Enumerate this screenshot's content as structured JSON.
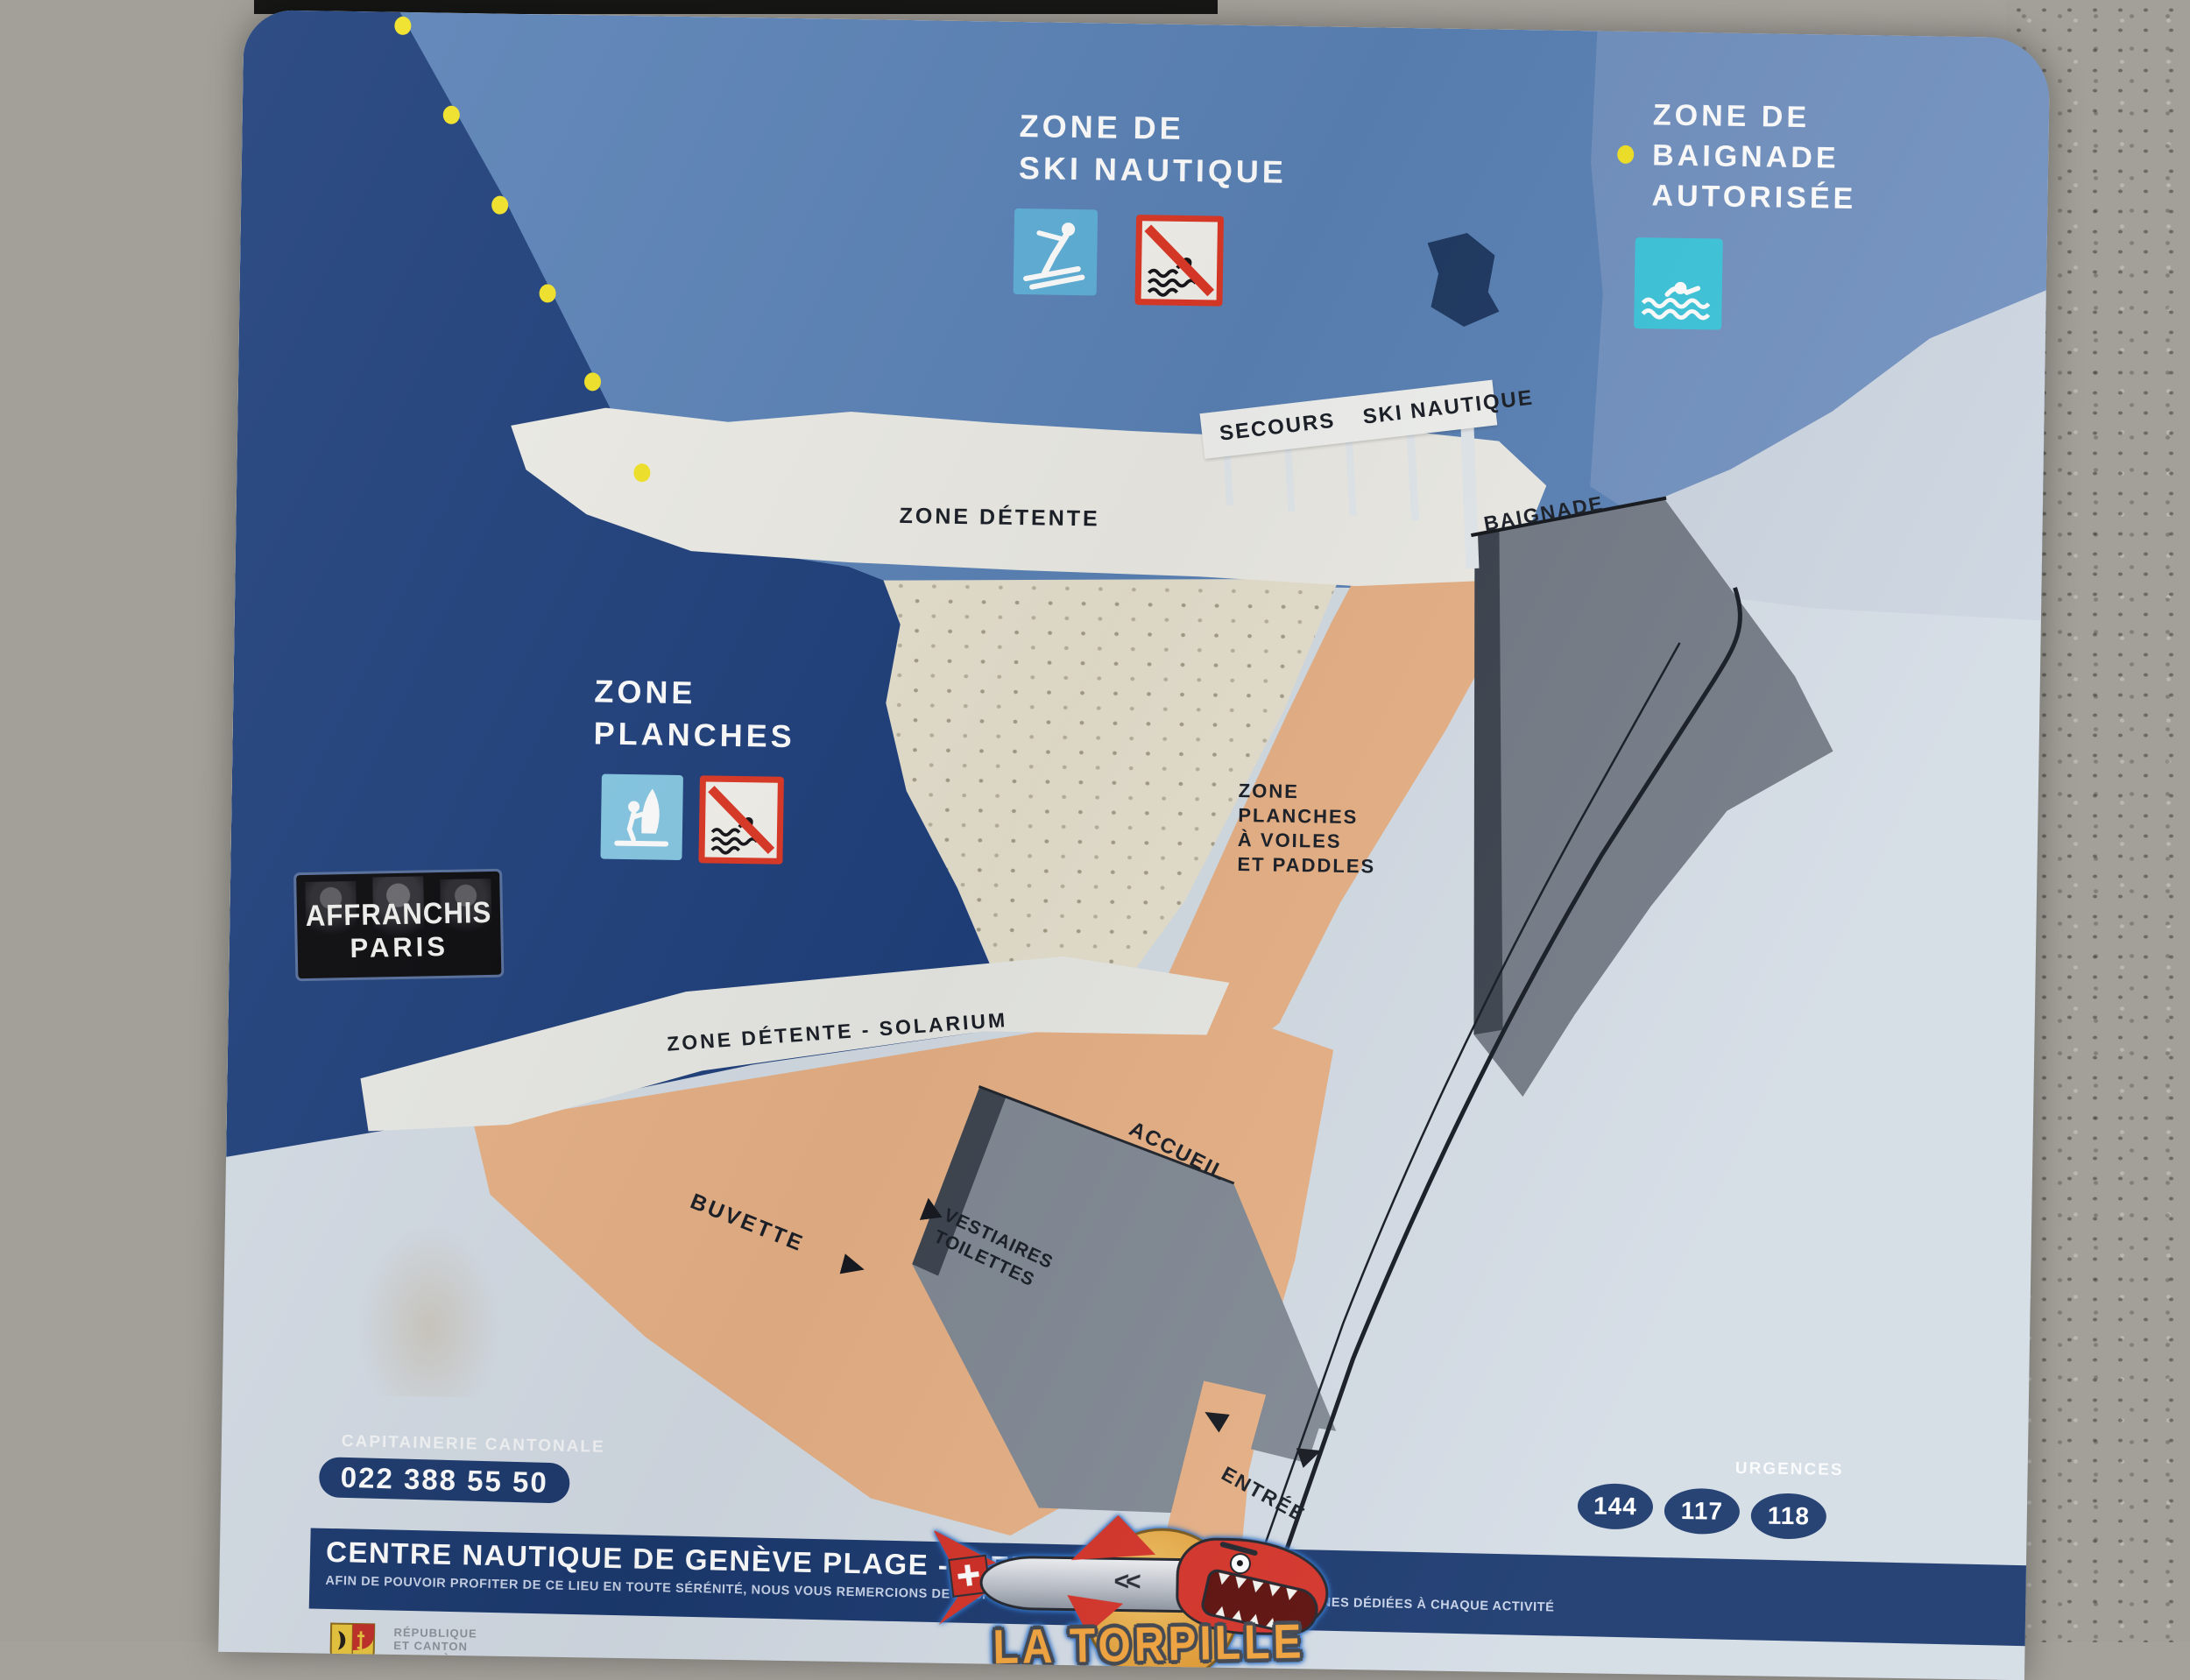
{
  "zones": {
    "ski": {
      "l1": "ZONE DE",
      "l2": "SKI NAUTIQUE"
    },
    "baignade": {
      "l1": "ZONE DE",
      "l2": "BAIGNADE",
      "l3": "AUTORISÉE"
    },
    "planches": {
      "l1": "ZONE",
      "l2": "PLANCHES"
    },
    "detente": "ZONE DÉTENTE",
    "voiles": {
      "l1": "ZONE",
      "l2": "PLANCHES",
      "l3": "À VOILES",
      "l4": "ET PADDLES"
    },
    "solarium": "ZONE DÉTENTE - SOLARIUM"
  },
  "labels": {
    "secours": "SECOURS",
    "ski_nautique": "SKI NAUTIQUE",
    "baignade": "BAIGNADE",
    "accueil": "ACCUEIL",
    "vestiaires_l1": "VESTIAIRES",
    "vestiaires_l2": "TOILETTES",
    "buvette": "BUVETTE",
    "entree": "ENTRÉE"
  },
  "capitainerie": {
    "title": "CAPITAINERIE CANTONALE",
    "phone": "022 388 55 50"
  },
  "urgences": {
    "title": "URGENCES",
    "numbers": [
      "144",
      "117",
      "118"
    ]
  },
  "footer": {
    "title": "CENTRE NAUTIQUE DE GENÈVE PLAGE - BIENVENUE",
    "subtitle": "AFIN DE POUVOIR PROFITER DE CE LIEU EN TOUTE SÉRÉNITÉ, NOUS VOUS REMERCIONS DE RESPECTER LES CONSIGNES DE SÉCURITÉ ET LES ZONES DÉDIÉES À CHAQUE ACTIVITÉ"
  },
  "canton": {
    "l1": "RÉPUBLIQUE",
    "l2": "ET CANTON",
    "l3": "DE GENÈVE"
  },
  "sticker": {
    "l1": "AFFRANCHIS",
    "l2": "PARIS"
  },
  "watermark": {
    "title": "LA TORPILLE"
  },
  "icons": {
    "ski": "water-ski-icon",
    "no_swimming": "no-swimming-icon",
    "windsurf": "windsurf-icon",
    "swimmer": "swimmer-icon",
    "coat_of_arms": "geneva-coat-of-arms",
    "shark": "shark-torpedo-logo"
  },
  "colors": {
    "navy_water": "#20407c",
    "ski_water": "#5b83b7",
    "baignade_water": "#7392c1",
    "sand_dotted": "#e7e1cf",
    "beach": "#edece6",
    "walkway_tan": "#e7b186",
    "land_light": "#d4dce5",
    "building_gray": "#828a95",
    "footer_navy": "#1c3a70",
    "buoy_yellow": "#f2e327",
    "icon_cyan": "#3ec5da",
    "icon_blue": "#5fb0d8",
    "alert_red": "#dd3826"
  }
}
